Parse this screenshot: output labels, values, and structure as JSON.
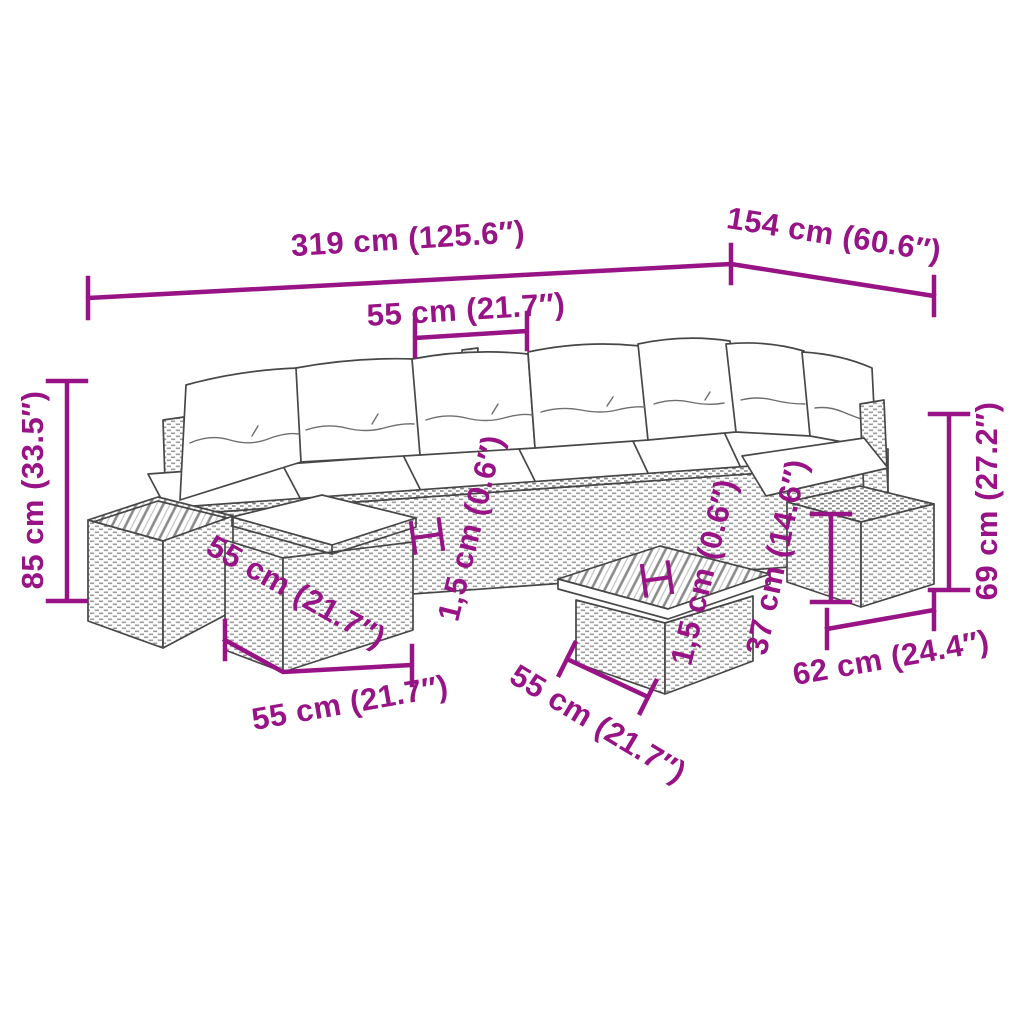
{
  "colors": {
    "accent_magenta": "#981385",
    "line_art": "#474747",
    "background": "#ffffff"
  },
  "labels": {
    "total_length": "319 cm (125.6″)",
    "total_depth": "154 cm (60.6″)",
    "seat_width": "55 cm (21.7″)",
    "total_height": "85 cm (33.5″)",
    "back_height": "69 cm (27.2″)",
    "stool_height": "37 cm (14.6″)",
    "stool_width": "62 cm (24.4″)",
    "ottoman_depth": "55 cm (21.7″)",
    "ottoman_width": "55 cm (21.7″)",
    "coffee_table_width": "55 cm (21.7″)",
    "top_thickness_left": "1,5 cm (0.6″)",
    "top_thickness_right": "1,5 cm (0.6″)"
  }
}
